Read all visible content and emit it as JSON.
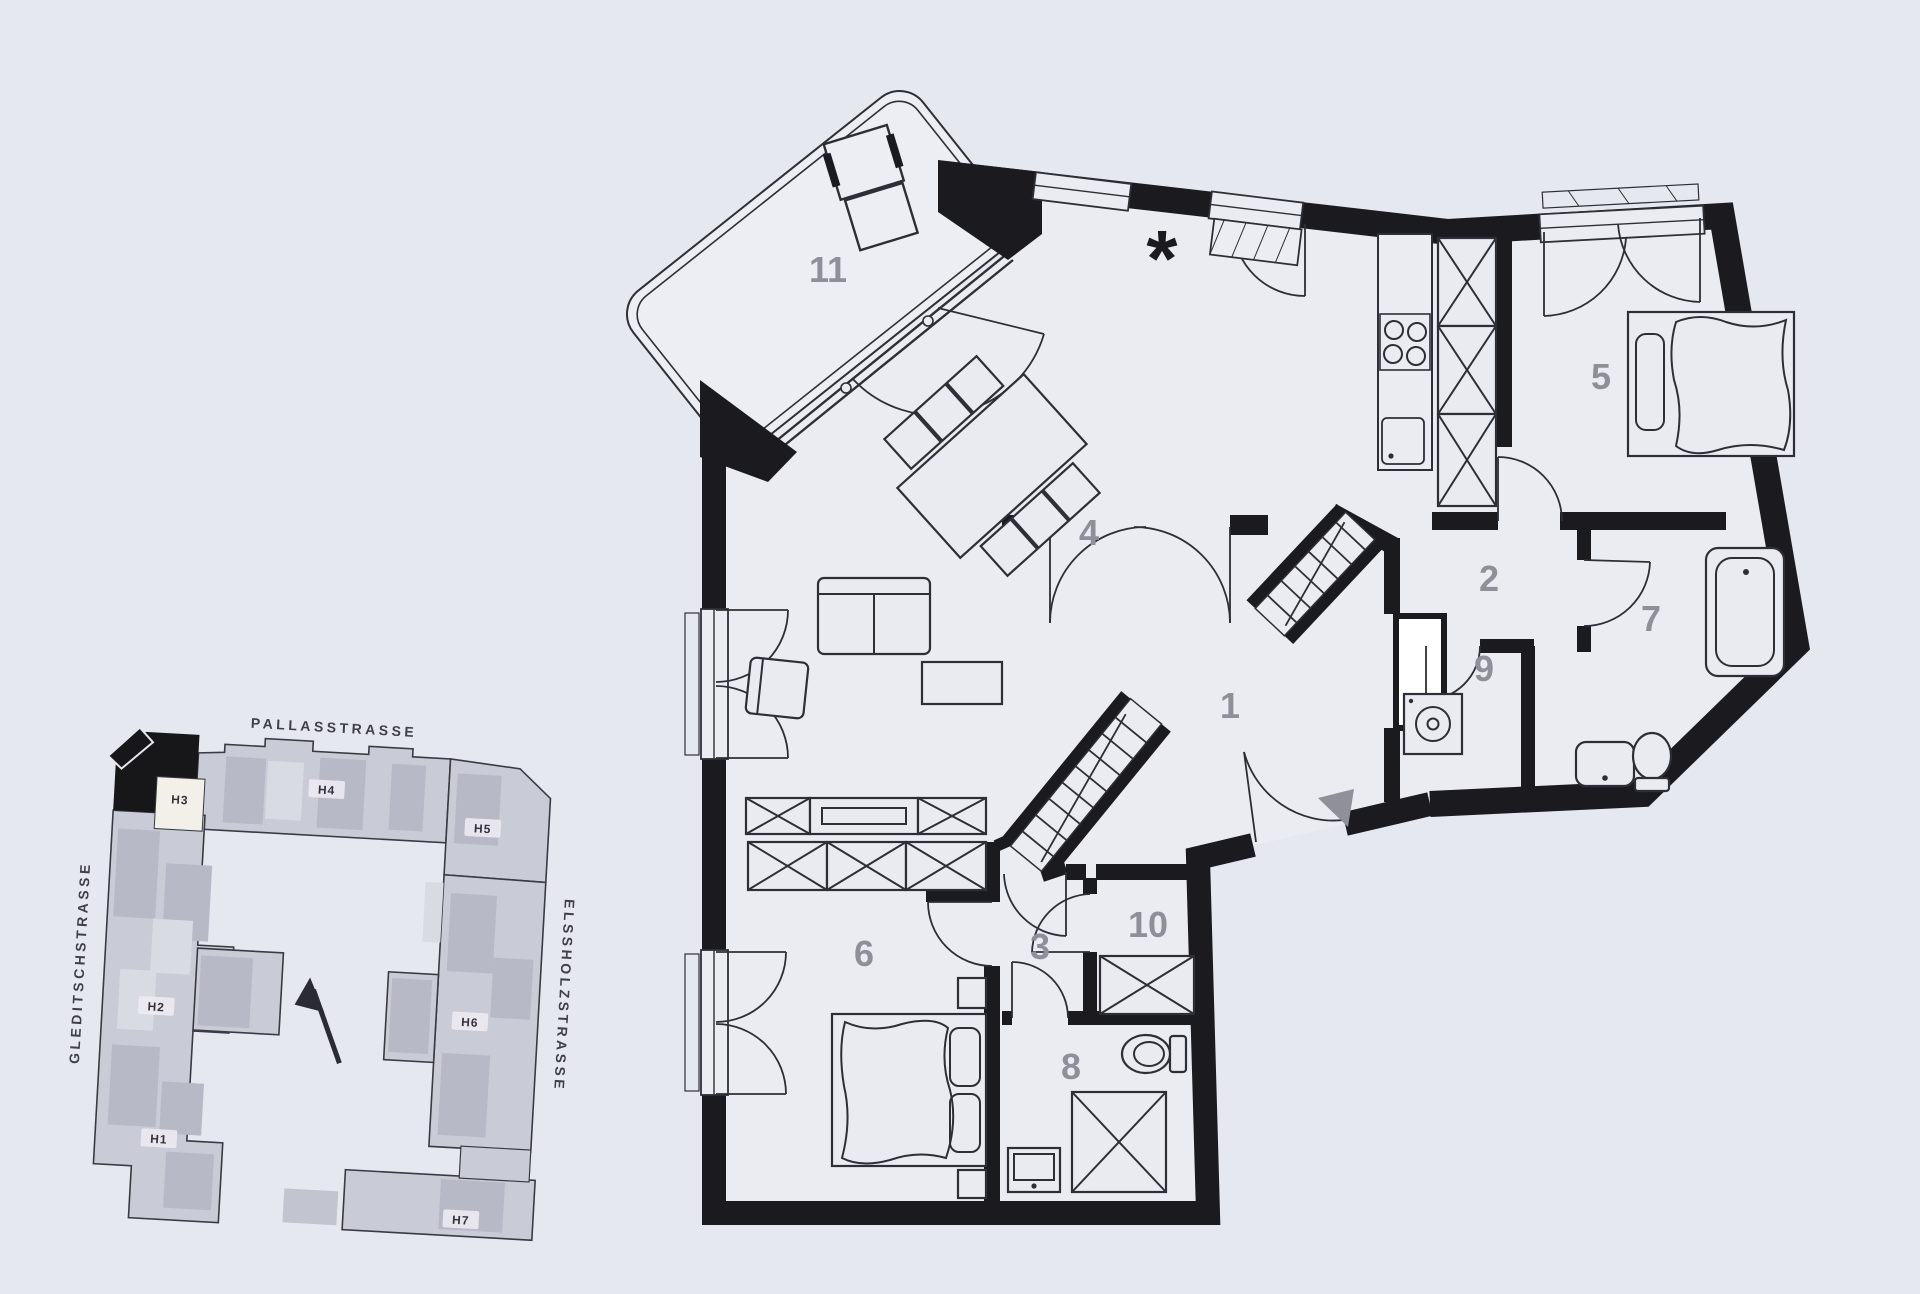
{
  "floor_plan": {
    "rooms": [
      {
        "number": "1"
      },
      {
        "number": "2"
      },
      {
        "number": "3"
      },
      {
        "number": "4"
      },
      {
        "number": "5"
      },
      {
        "number": "6"
      },
      {
        "number": "7"
      },
      {
        "number": "8"
      },
      {
        "number": "9"
      },
      {
        "number": "10"
      },
      {
        "number": "11"
      }
    ],
    "symbols": {
      "kitchen_star": "*"
    }
  },
  "site_plan": {
    "streets": {
      "top": "PALLASSTRASSE",
      "left": "GLEDITSCHSTRASSE",
      "right": "ELSSHOLZSTRASSE"
    },
    "buildings": [
      {
        "label": "H1"
      },
      {
        "label": "H2"
      },
      {
        "label": "H3"
      },
      {
        "label": "H4"
      },
      {
        "label": "H5"
      },
      {
        "label": "H6"
      },
      {
        "label": "H7"
      }
    ]
  },
  "colors": {
    "background": "#e6e8ef",
    "wall": "#1b1b1f",
    "room_label": "#8e8f99",
    "site_building": "#c9cbd6",
    "site_building_dark": "#b7b9c6",
    "site_black_unit": "#17171a",
    "site_cream": "#f2f0e9",
    "entrance_triangle": "#8f9099"
  }
}
